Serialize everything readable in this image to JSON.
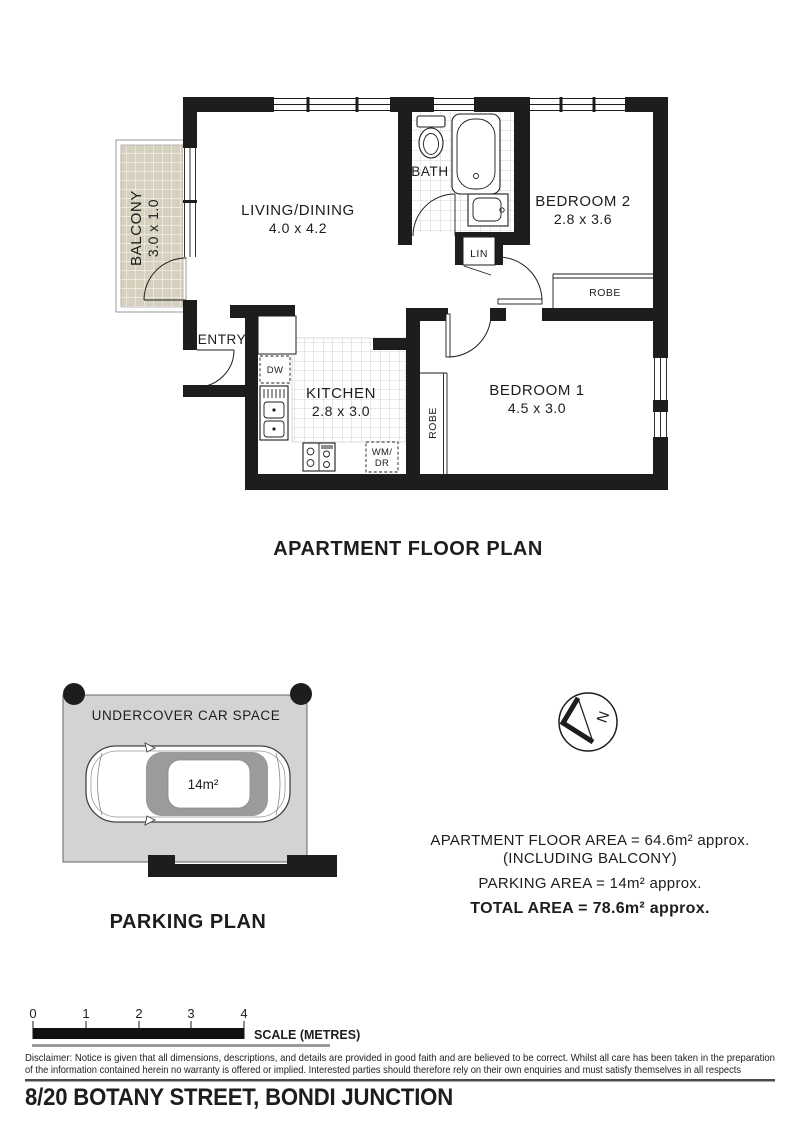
{
  "floor_plan": {
    "title": "APARTMENT FLOOR PLAN",
    "living": {
      "name": "LIVING/DINING",
      "dims": "4.0 x 4.2"
    },
    "kitchen": {
      "name": "KITCHEN",
      "dims": "2.8 x 3.0"
    },
    "bedroom1": {
      "name": "BEDROOM 1",
      "dims": "4.5 x 3.0"
    },
    "bedroom2": {
      "name": "BEDROOM 2",
      "dims": "2.8 x 3.6"
    },
    "bath": {
      "name": "BATH"
    },
    "balcony": {
      "name": "BALCONY",
      "dims": "3.0 x 1.0"
    },
    "entry": {
      "name": "ENTRY"
    },
    "linen": "LIN",
    "robe_bedroom1": "ROBE",
    "robe_bedroom2": "ROBE",
    "dishwasher": "DW",
    "washer_line1": "WM/",
    "washer_line2": "DR"
  },
  "parking": {
    "title": "PARKING PLAN",
    "space_label": "UNDERCOVER CAR SPACE",
    "car_area": "14m²"
  },
  "compass": {
    "north": "N"
  },
  "area_summary": {
    "line1": "APARTMENT FLOOR AREA = 64.6m² approx.",
    "line2": "(INCLUDING BALCONY)",
    "line3": "PARKING AREA = 14m² approx.",
    "line4": "TOTAL AREA = 78.6m² approx."
  },
  "scale_bar": {
    "ticks": [
      "0",
      "1",
      "2",
      "3",
      "4"
    ],
    "label": "SCALE (METRES)"
  },
  "disclaimer": {
    "line1": "Disclaimer: Notice is given that all dimensions, descriptions, and details are provided in good faith and are believed to be correct. Whilst all care has been taken in the preparation",
    "line2": "of the information contained herein no warranty is offered or implied. Interested parties should therefore rely on their own enquiries and must satisfy themselves in all respects"
  },
  "address": "8/20 BOTANY STREET, BONDI JUNCTION",
  "colors": {
    "wall": "#1d1d1b",
    "balcony_fill": "#d6d1bf",
    "parking_fill": "#d3d3d3",
    "car_glass": "#9b9b9b",
    "tile_line": "#c6c6c6"
  }
}
